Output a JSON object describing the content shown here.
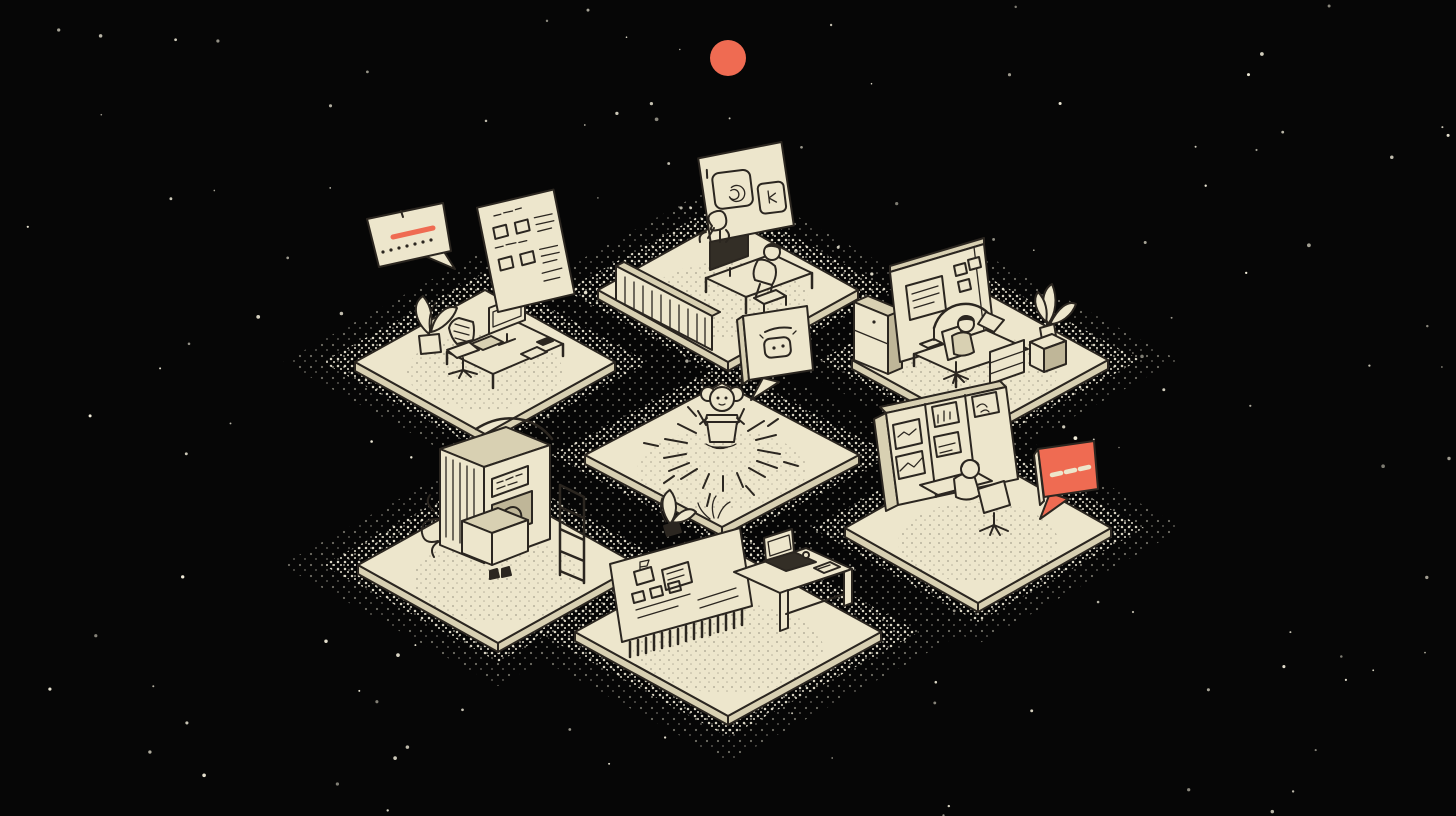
{
  "title": "Isometric night scene: seven floating cream platforms with workstations arranged around a central platform where a small robot mascot radiates light; speech bubbles float nearby under a red sun",
  "colors": {
    "bg": "#060606",
    "cream": "#EDE6CC",
    "cream_shade": "#D8D0B2",
    "cream_dark": "#BFB698",
    "ink": "#2B2620",
    "screen": "#332E26",
    "accent": "#EF6B52",
    "star": "#F2EDDA"
  },
  "scene": {
    "starfield": {
      "count": 150
    },
    "sun": {
      "label": "red circular sun floating top center"
    },
    "mascot": {
      "label": "small robot mascot with round ears sitting in a pot, radiating sunburst dashes"
    },
    "platforms": [
      {
        "id": "upper-left",
        "label": "empty desk with monitor, keyboard, office chair and potted plant"
      },
      {
        "id": "top-center",
        "label": "person working at a desk with dark monitor beside a slatted divider, floating whiteboard above"
      },
      {
        "id": "upper-right",
        "label": "cubicle with back wall screen and sticky notes, cabinet, arched lamp, seated person and tall plant"
      },
      {
        "id": "center",
        "label": "central platform with glowing robot mascot"
      },
      {
        "id": "lower-left",
        "label": "large fabrication machine with label panel, hatched sides, ladder rack and vine tendrils"
      },
      {
        "id": "bottom-center",
        "label": "wide wireframe whiteboard with plants and a desk with dark laptop and papers"
      },
      {
        "id": "lower-right",
        "label": "multi-screen monitoring wall with charts and a seated person in an office chair"
      }
    ],
    "speech_bubbles": [
      {
        "id": "alert",
        "label": "cream speech bubble with red underline stroke and a row of seven tiny characters"
      },
      {
        "id": "checklist",
        "label": "cream card with scribbled headings, four checkboxes and list lines"
      },
      {
        "id": "ai-chat",
        "label": "cream speech bubble containing a robot face icon"
      },
      {
        "id": "typing",
        "label": "red speech bubble with three light typing dashes",
        "dash_count": 3
      }
    ]
  }
}
